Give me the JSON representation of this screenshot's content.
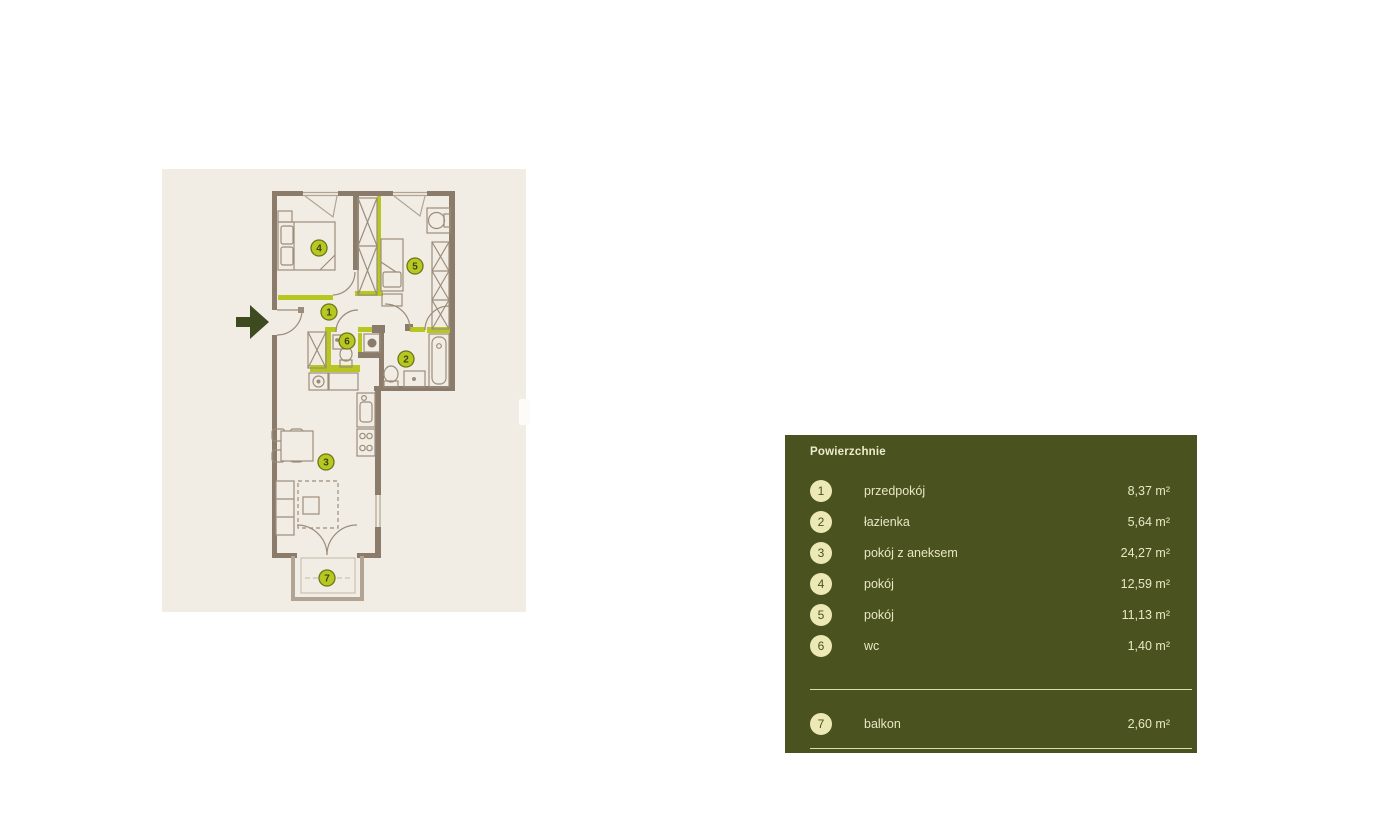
{
  "page": {
    "background": "#ffffff"
  },
  "floorplan": {
    "background": "#f1ede4",
    "wall_color": "#8a7b6a",
    "accent_wall_color": "#b7c620",
    "furniture_color": "#9c8d7b",
    "light_color": "#b2a492",
    "marker_fill": "#b8c823",
    "marker_border": "#6d7619",
    "marker_text_color": "#3c470f",
    "entrance_arrow_color": "#3e4a20",
    "markers": [
      {
        "number": "1",
        "x": 329,
        "y": 312
      },
      {
        "number": "2",
        "x": 406,
        "y": 359
      },
      {
        "number": "3",
        "x": 326,
        "y": 462
      },
      {
        "number": "4",
        "x": 319,
        "y": 248
      },
      {
        "number": "5",
        "x": 415,
        "y": 266
      },
      {
        "number": "6",
        "x": 347,
        "y": 341
      },
      {
        "number": "7",
        "x": 327,
        "y": 578
      }
    ]
  },
  "legend": {
    "title": "Powierzchnie",
    "panel_color": "#4a5320",
    "circle_color": "#ece9b5",
    "text_color": "#e9e7c4",
    "rooms": [
      {
        "number": "1",
        "label": "przedpokój",
        "area": "8,37 m²"
      },
      {
        "number": "2",
        "label": "łazienka",
        "area": "5,64 m²"
      },
      {
        "number": "3",
        "label": "pokój z aneksem",
        "area": "24,27 m²"
      },
      {
        "number": "4",
        "label": "pokój",
        "area": "12,59 m²"
      },
      {
        "number": "5",
        "label": "pokój",
        "area": "11,13 m²"
      },
      {
        "number": "6",
        "label": "wc",
        "area": "1,40 m²"
      }
    ],
    "extra": [
      {
        "number": "7",
        "label": "balkon",
        "area": "2,60 m²"
      }
    ]
  }
}
